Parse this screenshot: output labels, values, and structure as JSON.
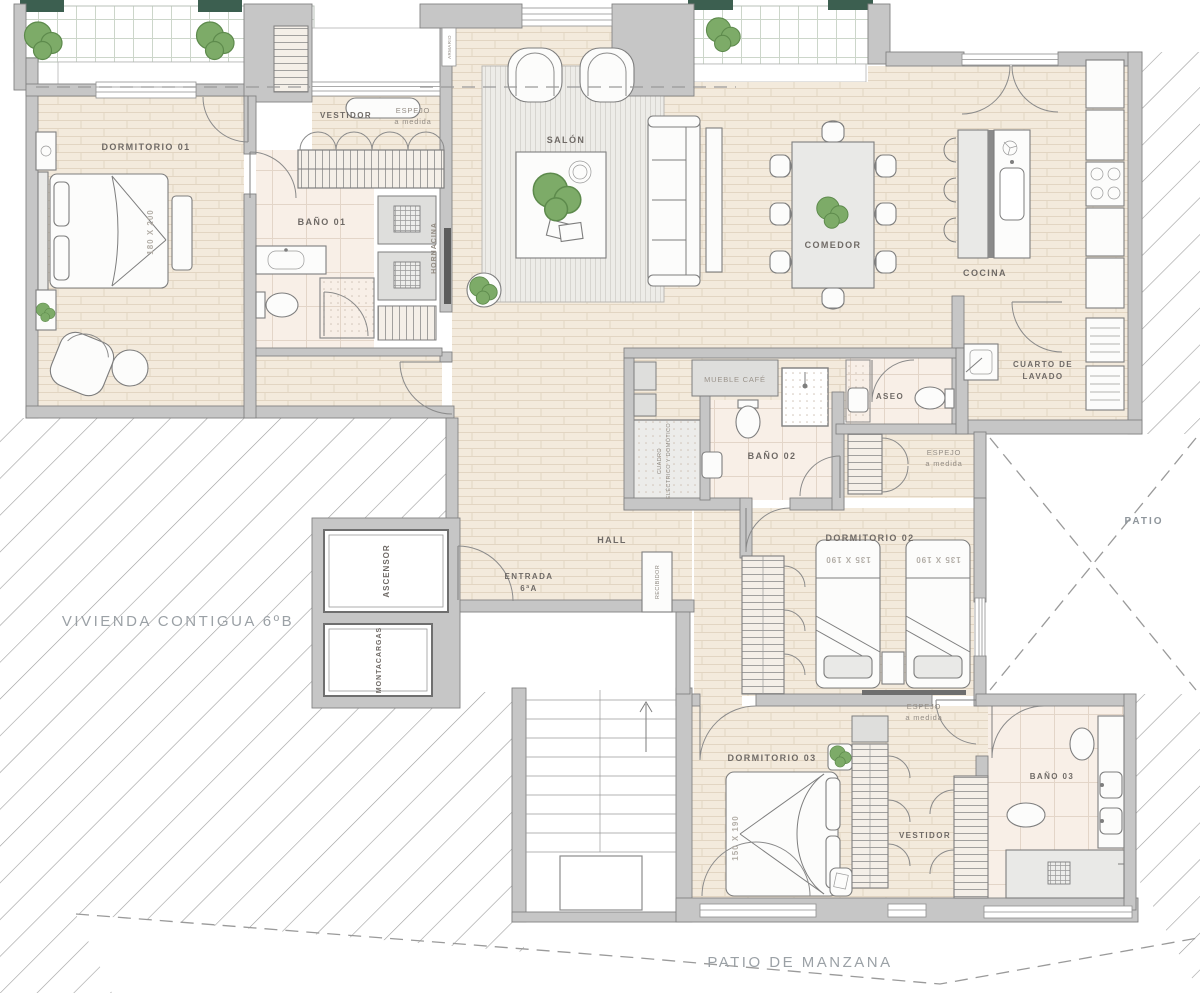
{
  "meta": {
    "type": "architectural-floor-plan",
    "language": "es"
  },
  "colors": {
    "wall": "#c6c6c6",
    "floor_wood": "#f3eadc",
    "floor_wood_line": "#e2d5c2",
    "floor_tile": "#f8efe7",
    "rug": "#edece8",
    "plant_green": "#7dab68",
    "plant_green_dark": "#5d8a4c",
    "planter_dark": "#3c5f50",
    "hatch_line": "#9e9e9e",
    "label": "#6f6a66",
    "label_light": "#948d85",
    "label_dim": "#b2ada6",
    "label_exterior": "#9ba1a6",
    "furniture_stroke": "#7e7e7e"
  },
  "rooms": {
    "dormitorio01": "DORMITORIO 01",
    "vestidor1": "VESTIDOR",
    "bano01": "BAÑO 01",
    "salon": "SALÓN",
    "comedor": "COMEDOR",
    "cocina": "COCINA",
    "cuarto_lavado_1": "CUARTO DE",
    "cuarto_lavado_2": "LAVADO",
    "aseo": "ASEO",
    "bano02": "BAÑO 02",
    "hall": "HALL",
    "dormitorio02": "DORMITORIO 02",
    "dormitorio03": "DORMITORIO 03",
    "vestidor2": "VESTIDOR",
    "bano03": "BAÑO 03",
    "patio": "PATIO",
    "vivienda_contigua": "VIVIENDA CONTIGUA 6ºB",
    "patio_manzana": "PATIO DE MANZANA"
  },
  "fixtures": {
    "mueble_cafe": "MUEBLE CAFÉ",
    "hornacina": "HORNACINA",
    "armario": "ARMARIO",
    "recibidor": "RECIBIDOR",
    "ascensor": "ASCENSOR",
    "montacargas": "MONTACARGAS",
    "cuadro_1": "CUADRO",
    "cuadro_2": "ELÉCTRICO Y DOMÓTICO",
    "espejo": "ESPEJO",
    "a_medida": "a medida",
    "entrada_1": "ENTRADA",
    "entrada_2": "6ªA"
  },
  "dimensions": {
    "bed_principal": "180 X 200",
    "bed_twin": "135 X 190",
    "bed_third": "150 X 190"
  }
}
